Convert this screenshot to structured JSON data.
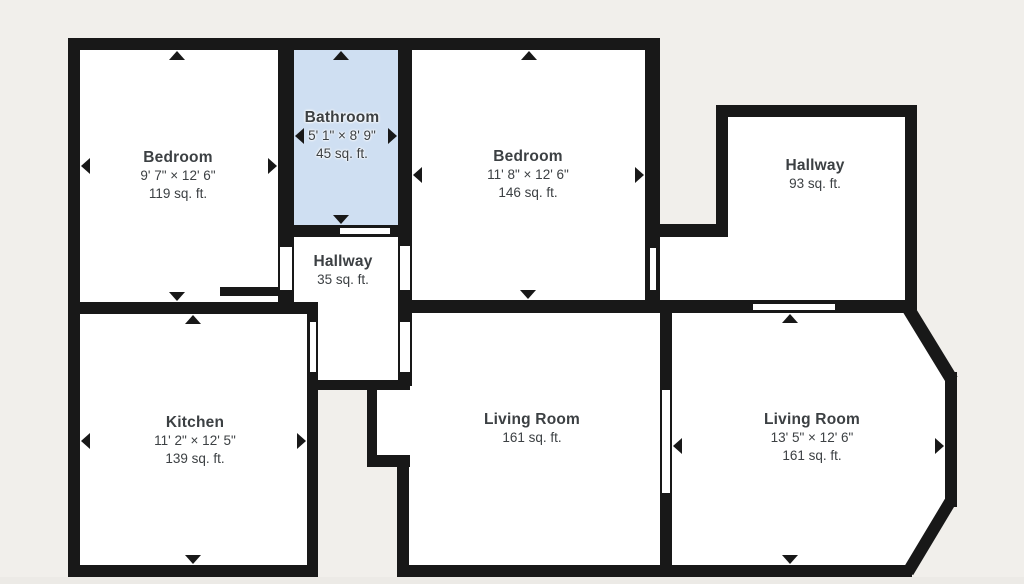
{
  "canvas": {
    "background": "#f1efeb",
    "bottom_strip": "#eceae6",
    "wall_color": "#181818",
    "room_fill": "#ffffff",
    "bathroom_highlight": "#cfdff2",
    "label_color": "#3c4043"
  },
  "rooms": [
    {
      "id": "bedroom-1",
      "name": "Bedroom",
      "dimensions": "9' 7\" × 12' 6\"",
      "area": "119 sq. ft.",
      "highlighted": false
    },
    {
      "id": "bathroom",
      "name": "Bathroom",
      "dimensions": "5' 1\" × 8' 9\"",
      "area": "45 sq. ft.",
      "highlighted": true
    },
    {
      "id": "bedroom-2",
      "name": "Bedroom",
      "dimensions": "11' 8\" × 12' 6\"",
      "area": "146 sq. ft.",
      "highlighted": false
    },
    {
      "id": "hallway-upper",
      "name": "Hallway",
      "dimensions": "",
      "area": "93 sq. ft.",
      "highlighted": false
    },
    {
      "id": "hallway-middle",
      "name": "Hallway",
      "dimensions": "",
      "area": "35 sq. ft.",
      "highlighted": false
    },
    {
      "id": "kitchen",
      "name": "Kitchen",
      "dimensions": "11' 2\" × 12' 5\"",
      "area": "139 sq. ft.",
      "highlighted": false
    },
    {
      "id": "living-room-middle",
      "name": "Living Room",
      "dimensions": "",
      "area": "161 sq. ft.",
      "highlighted": false
    },
    {
      "id": "living-room-right",
      "name": "Living Room",
      "dimensions": "13' 5\" × 12' 6\"",
      "area": "161 sq. ft.",
      "highlighted": false
    }
  ]
}
